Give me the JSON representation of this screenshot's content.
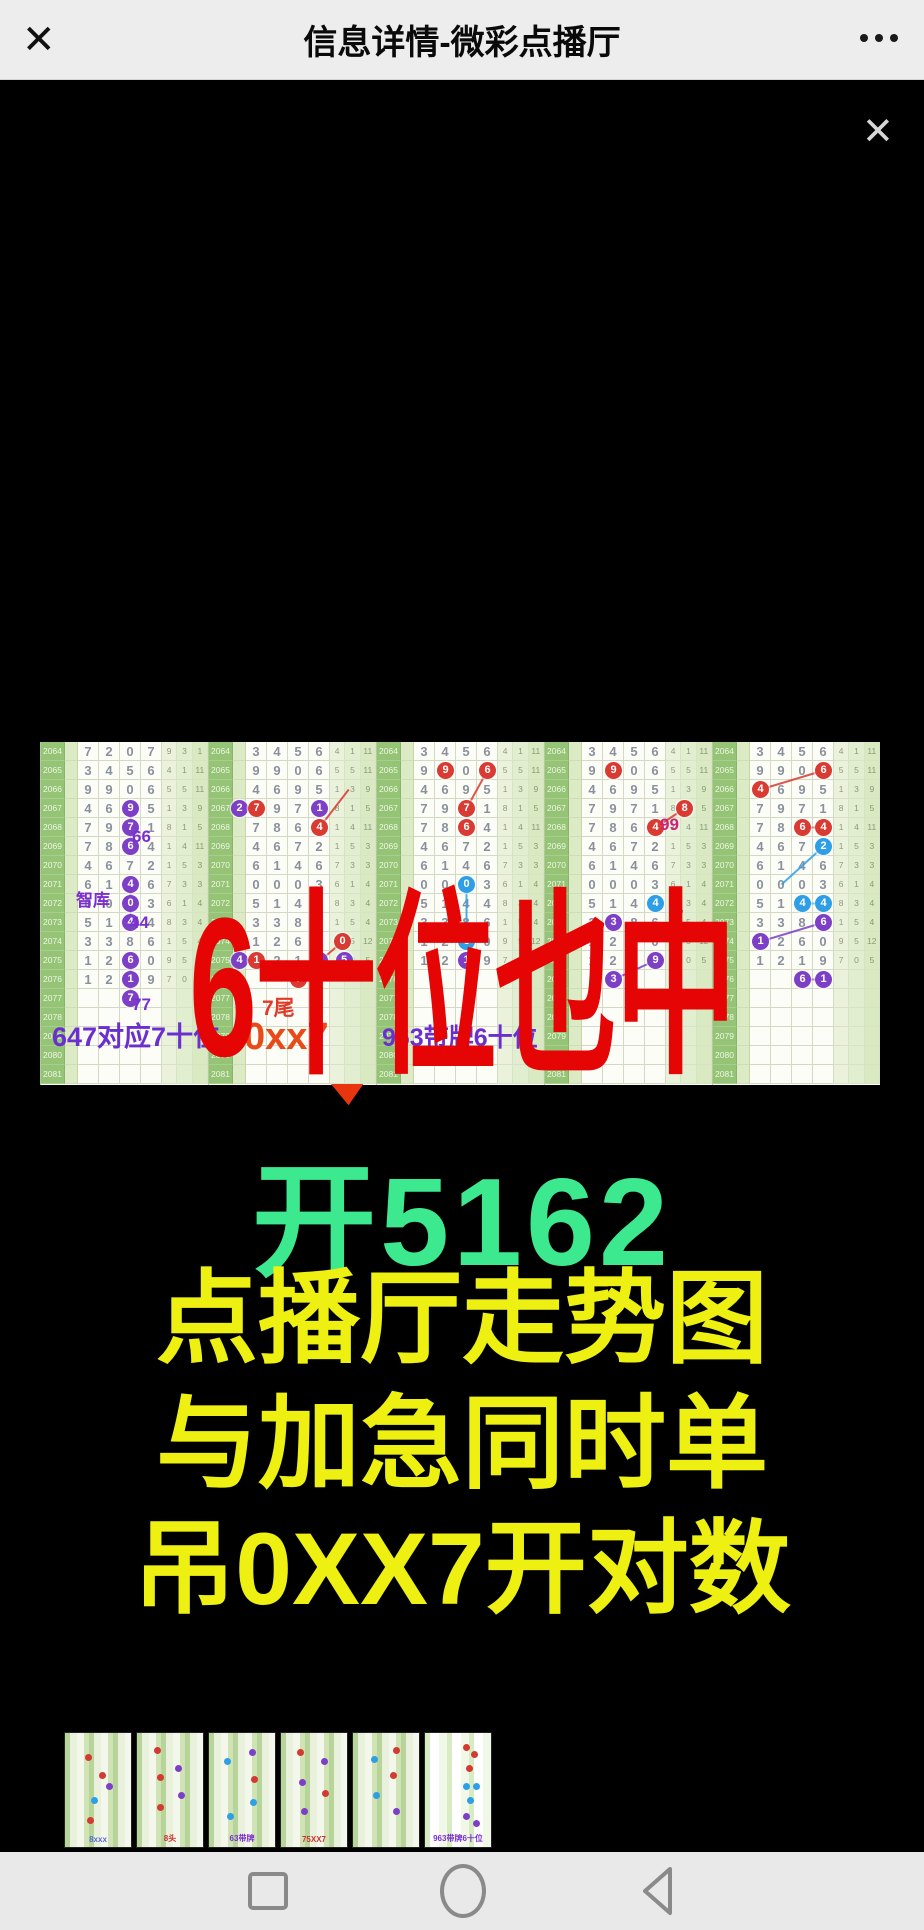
{
  "titlebar": {
    "close_label": "✕",
    "title": "信息详情-微彩点播厅",
    "menu_icon": "more-dots"
  },
  "viewer": {
    "close_label": "✕"
  },
  "colors": {
    "headline_red": "#e60505",
    "result_green": "#3ce98e",
    "promo_yellow": "#eef011",
    "check_red": "#e8350e",
    "circle_red": "#d93a31",
    "circle_purple": "#7d3fc6",
    "circle_blue": "#2e9fe6",
    "anno_purple": "#7a2fd0",
    "anno_deep_purple": "#6b2fd0",
    "anno_red": "#e13a28",
    "anno_orange_red": "#e84a18",
    "anno_magenta": "#cc2277"
  },
  "chart": {
    "periods": [
      "2064",
      "2065",
      "2066",
      "2067",
      "2068",
      "2069",
      "2070",
      "2071",
      "2072",
      "2073",
      "2074",
      "2075",
      "2076",
      "2077",
      "2078",
      "2079",
      "2080",
      "2081"
    ],
    "row_digits": [
      "7207",
      "3456",
      "9906",
      "4695",
      "7971",
      "7864",
      "4672",
      "6146",
      "0003",
      "5144",
      "3386",
      "1260",
      "1219"
    ],
    "aux_digits": [
      [
        "9",
        "3",
        "1"
      ],
      [
        "4",
        "1",
        "11"
      ],
      [
        "5",
        "5",
        "11"
      ],
      [
        "1",
        "3",
        "9"
      ],
      [
        "8",
        "1",
        "5"
      ],
      [
        "1",
        "4",
        "11"
      ],
      [
        "1",
        "5",
        "3"
      ],
      [
        "7",
        "3",
        "3"
      ],
      [
        "6",
        "1",
        "4"
      ],
      [
        "8",
        "3",
        "4"
      ],
      [
        "1",
        "5",
        "4"
      ],
      [
        "9",
        "5",
        "12"
      ],
      [
        "7",
        "0",
        "5"
      ]
    ],
    "panels": [
      {
        "offset": 0,
        "circles": [
          [
            4,
            3,
            "pu"
          ],
          [
            5,
            3,
            "pu"
          ],
          [
            6,
            3,
            "pu"
          ],
          [
            8,
            3,
            "pu"
          ],
          [
            9,
            3,
            "pu"
          ],
          [
            10,
            3,
            "pu"
          ],
          [
            12,
            3,
            "pu"
          ],
          [
            13,
            3,
            "pu"
          ],
          [
            14,
            3,
            "pu",
            "7"
          ]
        ],
        "lines": [
          [
            4,
            3,
            6,
            3,
            "pu"
          ],
          [
            8,
            3,
            10,
            3,
            "pu"
          ],
          [
            12,
            3,
            14,
            3,
            "pu"
          ]
        ]
      },
      {
        "offset": 1,
        "circles": [
          [
            4,
            0,
            "pu",
            "2"
          ],
          [
            4,
            1,
            "r"
          ],
          [
            4,
            4,
            "pu"
          ],
          [
            5,
            4,
            "r"
          ],
          [
            12,
            0,
            "pu",
            "4"
          ],
          [
            12,
            1,
            "r"
          ],
          [
            12,
            4,
            "pu"
          ],
          [
            12,
            4.9,
            "pu",
            "5"
          ],
          [
            11,
            4.8,
            "r",
            "0"
          ],
          [
            13,
            3,
            "r",
            "7"
          ]
        ],
        "lines": [
          [
            13,
            3,
            11,
            4.8,
            "r"
          ],
          [
            5,
            4,
            3,
            5.2,
            "r"
          ]
        ]
      },
      {
        "offset": 1,
        "circles": [
          [
            2,
            2,
            "r"
          ],
          [
            2,
            4,
            "r"
          ],
          [
            4,
            3,
            "r"
          ],
          [
            5,
            3,
            "r"
          ],
          [
            8,
            3,
            "b"
          ],
          [
            11,
            3,
            "b"
          ],
          [
            12,
            3,
            "pu"
          ]
        ],
        "lines": [
          [
            4,
            3,
            2,
            4,
            "r"
          ],
          [
            8,
            3,
            11,
            3,
            "b"
          ]
        ]
      },
      {
        "offset": 1,
        "circles": [
          [
            2,
            2,
            "r"
          ],
          [
            5,
            4,
            "r"
          ],
          [
            4,
            5.2,
            "r",
            "8"
          ],
          [
            9,
            4,
            "b"
          ],
          [
            10,
            2,
            "pu"
          ],
          [
            12,
            4,
            "pu"
          ],
          [
            13,
            2,
            "pu",
            "3"
          ]
        ],
        "lines": [
          [
            13,
            2,
            12,
            4,
            "pu"
          ],
          [
            5,
            4,
            4,
            5.2,
            "r"
          ]
        ]
      },
      {
        "offset": 1,
        "circles": [
          [
            2,
            4,
            "r"
          ],
          [
            3,
            1,
            "r"
          ],
          [
            5,
            3,
            "r"
          ],
          [
            5,
            4,
            "r"
          ],
          [
            6,
            4,
            "b"
          ],
          [
            9,
            3,
            "b"
          ],
          [
            9,
            4,
            "b"
          ],
          [
            10,
            4,
            "pu"
          ],
          [
            11,
            1,
            "pu"
          ],
          [
            13,
            3,
            "pu",
            "6"
          ],
          [
            13,
            4,
            "pu",
            "1"
          ]
        ],
        "lines": [
          [
            3,
            1,
            2,
            4,
            "r"
          ],
          [
            5,
            3,
            5,
            4,
            "r"
          ],
          [
            6,
            4,
            8,
            2,
            "b"
          ],
          [
            9,
            3,
            9,
            4,
            "b"
          ],
          [
            11,
            1,
            10,
            4,
            "pu"
          ],
          [
            13,
            3,
            13,
            4,
            "pu"
          ]
        ]
      }
    ],
    "annotations": [
      {
        "text": "智库",
        "x": 36,
        "y": 150,
        "color": "#7a2fd0",
        "size": 17
      },
      {
        "text": "66",
        "x": 92,
        "y": 86,
        "color": "#7a2fd0",
        "size": 17
      },
      {
        "text": "44",
        "x": 90,
        "y": 172,
        "color": "#7a2fd0",
        "size": 17
      },
      {
        "text": "77",
        "x": 92,
        "y": 254,
        "color": "#7a2fd0",
        "size": 17
      },
      {
        "text": "99",
        "x": 620,
        "y": 74,
        "color": "#cc2277",
        "size": 17
      },
      {
        "text": "36",
        "x": 630,
        "y": 162,
        "color": "#8a35d6",
        "size": 12
      },
      {
        "text": "33",
        "x": 618,
        "y": 248,
        "color": "#d42a2a",
        "size": 17
      },
      {
        "text": "7尾",
        "x": 222,
        "y": 256,
        "color": "#e13a28",
        "size": 21
      },
      {
        "text": "0xx7",
        "x": 204,
        "y": 276,
        "color": "#e84a18",
        "size": 38
      },
      {
        "text": "647对应7十位",
        "x": 12,
        "y": 282,
        "color": "#6b2fd0",
        "size": 27
      },
      {
        "text": "963带牌6十位",
        "x": 342,
        "y": 284,
        "color": "#6b2fd0",
        "size": 25
      }
    ]
  },
  "overlay": {
    "headline": "6十位也中",
    "checkmark_icon": "check"
  },
  "result": {
    "text": "开5162"
  },
  "promo": {
    "lines": [
      "点播厅走势图",
      "与加急同时单",
      "吊0XX7开对数"
    ]
  },
  "thumbnails": [
    {
      "label": "8xxx",
      "label_color": "#5a6bd8",
      "dots": [
        [
          30,
          18,
          "r"
        ],
        [
          52,
          34,
          "r"
        ],
        [
          40,
          56,
          "b"
        ],
        [
          62,
          44,
          "pu"
        ],
        [
          34,
          74,
          "r"
        ]
      ]
    },
    {
      "label": "8头",
      "label_color": "#d03030",
      "dots": [
        [
          26,
          12,
          "r"
        ],
        [
          30,
          36,
          "r"
        ],
        [
          58,
          28,
          "pu"
        ],
        [
          62,
          52,
          "pu"
        ],
        [
          30,
          62,
          "r"
        ]
      ]
    },
    {
      "label": "63带牌",
      "label_color": "#7a2fd0",
      "dots": [
        [
          22,
          22,
          "b"
        ],
        [
          60,
          14,
          "pu"
        ],
        [
          64,
          38,
          "r"
        ],
        [
          62,
          58,
          "b"
        ],
        [
          28,
          70,
          "b"
        ]
      ]
    },
    {
      "label": "75XX7",
      "label_color": "#d03030",
      "dots": [
        [
          24,
          14,
          "r"
        ],
        [
          28,
          40,
          "pu"
        ],
        [
          60,
          22,
          "pu"
        ],
        [
          62,
          50,
          "r"
        ],
        [
          30,
          66,
          "pu"
        ]
      ]
    },
    {
      "label": "",
      "label_color": "#7a2fd0",
      "dots": [
        [
          28,
          20,
          "b"
        ],
        [
          60,
          12,
          "r"
        ],
        [
          56,
          34,
          "r"
        ],
        [
          30,
          52,
          "b"
        ],
        [
          60,
          66,
          "pu"
        ]
      ]
    },
    {
      "label": "963带牌6十位",
      "label_color": "#7a2fd0",
      "dots": [
        [
          58,
          10,
          "r"
        ],
        [
          70,
          16,
          "r"
        ],
        [
          62,
          28,
          "r"
        ],
        [
          58,
          44,
          "b"
        ],
        [
          72,
          44,
          "b"
        ],
        [
          64,
          56,
          "b"
        ],
        [
          58,
          70,
          "pu"
        ],
        [
          72,
          76,
          "pu"
        ]
      ],
      "variant": "light"
    }
  ],
  "navbar": {
    "recents_icon": "square",
    "home_icon": "circle",
    "back_icon": "triangle-left"
  }
}
